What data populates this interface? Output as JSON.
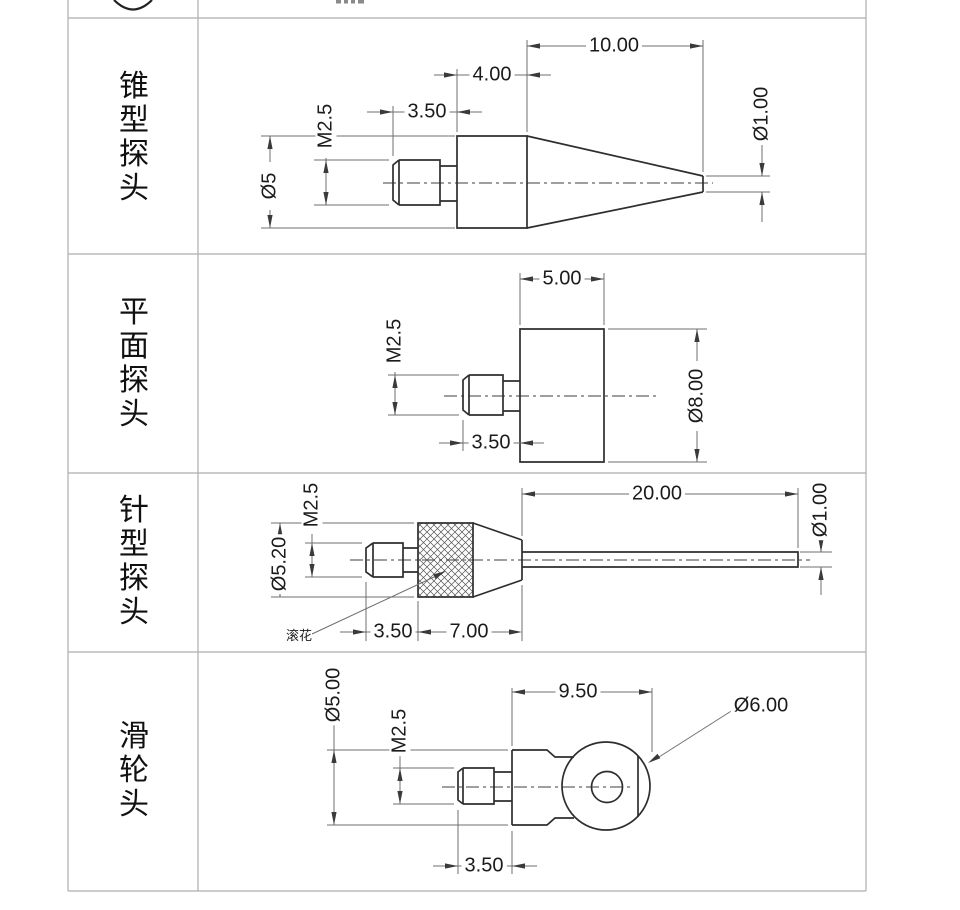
{
  "table": {
    "rows": [
      {
        "name": "cone-probe",
        "label": "锥型探头",
        "dims": {
          "total_length": "10.00",
          "body_length": "4.00",
          "thread_length": "3.50",
          "thread_spec": "M2.5",
          "body_dia": "Ø5",
          "tip_dia": "Ø1.00"
        }
      },
      {
        "name": "flat-probe",
        "label": "平面探头",
        "dims": {
          "body_length": "5.00",
          "thread_spec": "M2.5",
          "body_dia": "Ø8.00",
          "thread_length": "3.50"
        }
      },
      {
        "name": "needle-probe",
        "label": "针型探头",
        "dims": {
          "thread_spec": "M2.5",
          "body_dia": "Ø5.20",
          "needle_length": "20.00",
          "needle_dia": "Ø1.00",
          "knurl_note": "滚花",
          "thread_length": "3.50",
          "body_length": "7.00"
        }
      },
      {
        "name": "pulley-probe",
        "label": "滑轮头",
        "dims": {
          "body_dia": "Ø5.00",
          "thread_spec": "M2.5",
          "head_length": "9.50",
          "wheel_dia": "Ø6.00",
          "thread_length": "3.50"
        }
      }
    ]
  },
  "colors": {
    "outline": "#2e2e2e",
    "dim_line": "#6f6f6f",
    "grid": "#adadad",
    "text": "#1b1b1b"
  }
}
